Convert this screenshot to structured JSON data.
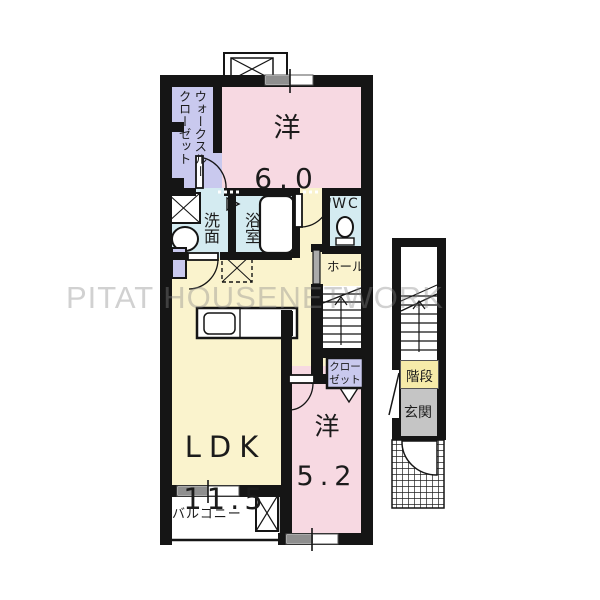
{
  "watermark": "PITAT HOUSENETWORK",
  "rooms": {
    "western_6": {
      "name": "洋",
      "size": "6.0"
    },
    "ldk": {
      "name": "LDK",
      "size": "11.5"
    },
    "western_5_2": {
      "name": "洋",
      "size": "5.2"
    },
    "walkthrough_closet": "ウォークスルー\nクローゼット",
    "washroom": "洗面",
    "bathroom": "浴室",
    "wc": "WC",
    "hall": "ホール",
    "closet": "クロー\nゼット",
    "balcony": "バルコニー",
    "stairs": "階段",
    "entrance": "玄関"
  },
  "colors": {
    "wall": "#151515",
    "room_pink": "#f7d9e2",
    "room_yellow": "#faf3cd",
    "room_purple": "#c9c9ee",
    "room_blue": "#d4ebf1",
    "entrance_gray": "#c5c5c5",
    "stairs_label_bg": "#f6eba9",
    "watermark_gray": "#d4d4d4"
  }
}
